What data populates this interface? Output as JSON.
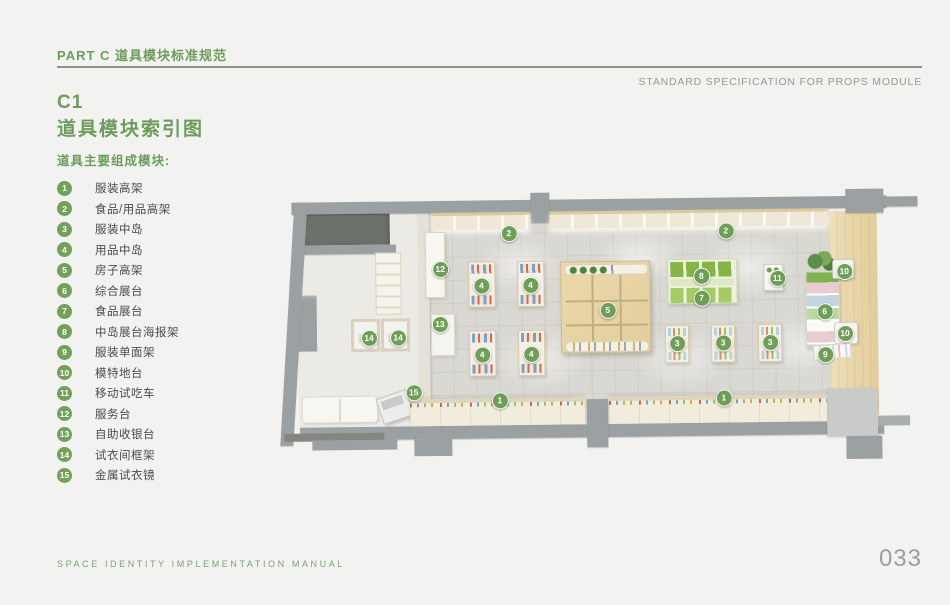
{
  "page": {
    "header": {
      "part_title": "PART C 道具模块标准规范",
      "subtitle_en": "STANDARD SPECIFICATION FOR PROPS MODULE"
    },
    "section": {
      "code": "C1",
      "title": "道具模块索引图"
    },
    "legend": {
      "title": "道具主要组成模块:",
      "items": [
        {
          "num": "1",
          "label": "服装高架"
        },
        {
          "num": "2",
          "label": "食品/用品高架"
        },
        {
          "num": "3",
          "label": "服装中岛"
        },
        {
          "num": "4",
          "label": "用品中岛"
        },
        {
          "num": "5",
          "label": "房子高架"
        },
        {
          "num": "6",
          "label": "综合展台"
        },
        {
          "num": "7",
          "label": "食品展台"
        },
        {
          "num": "8",
          "label": "中岛展台海报架"
        },
        {
          "num": "9",
          "label": "服装单面架"
        },
        {
          "num": "10",
          "label": "模特地台"
        },
        {
          "num": "11",
          "label": "移动试吃车"
        },
        {
          "num": "12",
          "label": "服务台"
        },
        {
          "num": "13",
          "label": "自助收银台"
        },
        {
          "num": "14",
          "label": "试衣间框架"
        },
        {
          "num": "15",
          "label": "金属试衣镜"
        }
      ]
    },
    "floorplan": {
      "markers": [
        {
          "n": "2",
          "x": 229,
          "y": 40
        },
        {
          "n": "2",
          "x": 446,
          "y": 40
        },
        {
          "n": "12",
          "x": 160,
          "y": 75
        },
        {
          "n": "4",
          "x": 201,
          "y": 92
        },
        {
          "n": "4",
          "x": 250,
          "y": 92
        },
        {
          "n": "8",
          "x": 421,
          "y": 85
        },
        {
          "n": "11",
          "x": 497,
          "y": 88
        },
        {
          "n": "10",
          "x": 564,
          "y": 82
        },
        {
          "n": "7",
          "x": 421,
          "y": 107
        },
        {
          "n": "5",
          "x": 327,
          "y": 118
        },
        {
          "n": "6",
          "x": 544,
          "y": 122
        },
        {
          "n": "13",
          "x": 159,
          "y": 130
        },
        {
          "n": "14",
          "x": 88,
          "y": 143
        },
        {
          "n": "14",
          "x": 117,
          "y": 143
        },
        {
          "n": "10",
          "x": 564,
          "y": 144
        },
        {
          "n": "3",
          "x": 396,
          "y": 152
        },
        {
          "n": "3",
          "x": 442,
          "y": 152
        },
        {
          "n": "3",
          "x": 489,
          "y": 152
        },
        {
          "n": "4",
          "x": 201,
          "y": 161
        },
        {
          "n": "4",
          "x": 250,
          "y": 161
        },
        {
          "n": "9",
          "x": 544,
          "y": 165
        },
        {
          "n": "15",
          "x": 132,
          "y": 198
        },
        {
          "n": "1",
          "x": 218,
          "y": 207
        },
        {
          "n": "1",
          "x": 442,
          "y": 207
        }
      ]
    },
    "footer": {
      "left": "SPACE IDENTITY IMPLEMENTATION MANUAL",
      "page_number": "033"
    },
    "colors": {
      "accent_green": "#6e9c5d",
      "marker_green": "#6f9e57",
      "text_gray": "#4b4b49",
      "wall_gray": "#9ba1a2",
      "wood": "#e8d7ac"
    }
  }
}
